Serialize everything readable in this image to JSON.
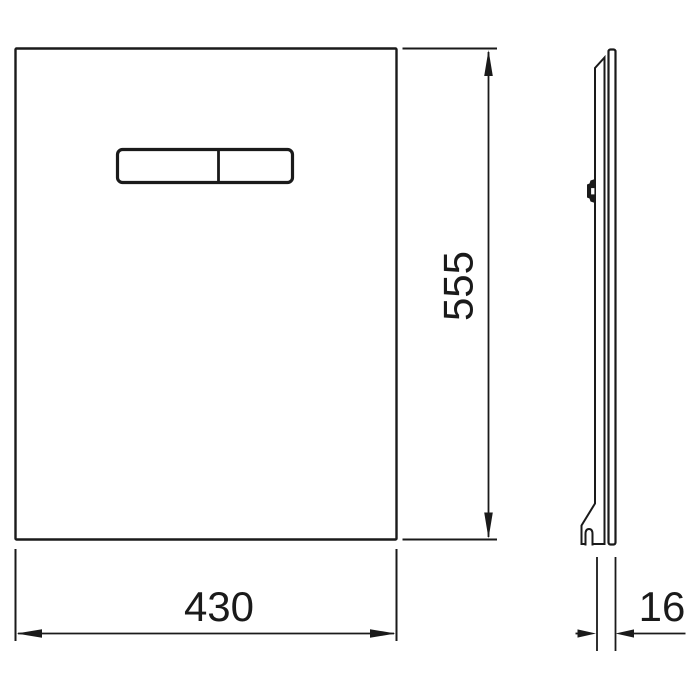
{
  "drawing": {
    "kind": "technical dimension drawing",
    "subject": "glass flush plate with dual flush button bar",
    "background_color": "#ffffff",
    "line_color": "#1a1a1a",
    "views": {
      "front": {
        "name": "front view"
      },
      "side": {
        "name": "side profile view"
      }
    },
    "dimensions": {
      "width": {
        "value": "430",
        "orientation": "horizontal",
        "applies_to": "front view width"
      },
      "height": {
        "value": "555",
        "orientation": "vertical",
        "applies_to": "front view height"
      },
      "depth": {
        "value": "16",
        "orientation": "horizontal",
        "applies_to": "side view thickness"
      }
    }
  }
}
